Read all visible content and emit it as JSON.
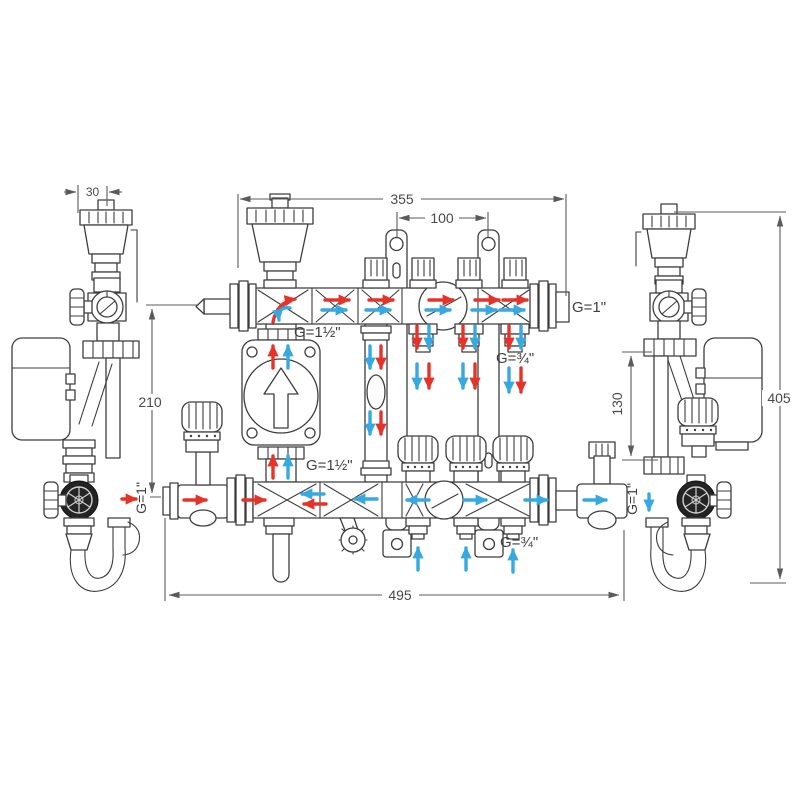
{
  "meta": {
    "drawing_type": "Heating manifold pump-group dimensional technical drawing",
    "views": [
      "left-side-view",
      "front-view",
      "right-side-view"
    ],
    "units": "mm"
  },
  "dims": {
    "bracket_offset": "30",
    "manifold_length": "355",
    "bracket_spacing": "100",
    "left_height": "210",
    "right_union_height": "130",
    "overall_height": "405",
    "overall_width": "495"
  },
  "ports": {
    "manifold_end": "G=1\"",
    "left_connection": "G=1\"",
    "right_connection": "G=1\"",
    "pump_union_top": "G=1½\"",
    "pump_union_bottom": "G=1½\"",
    "loop_top": "G=¾\"",
    "loop_bottom": "G=¾\""
  },
  "colors": {
    "supply_flow": "#e6332a",
    "return_flow": "#36a9e1",
    "outline": "#3d3d3d",
    "dimension": "#5b5b5b",
    "background": "#ffffff"
  }
}
